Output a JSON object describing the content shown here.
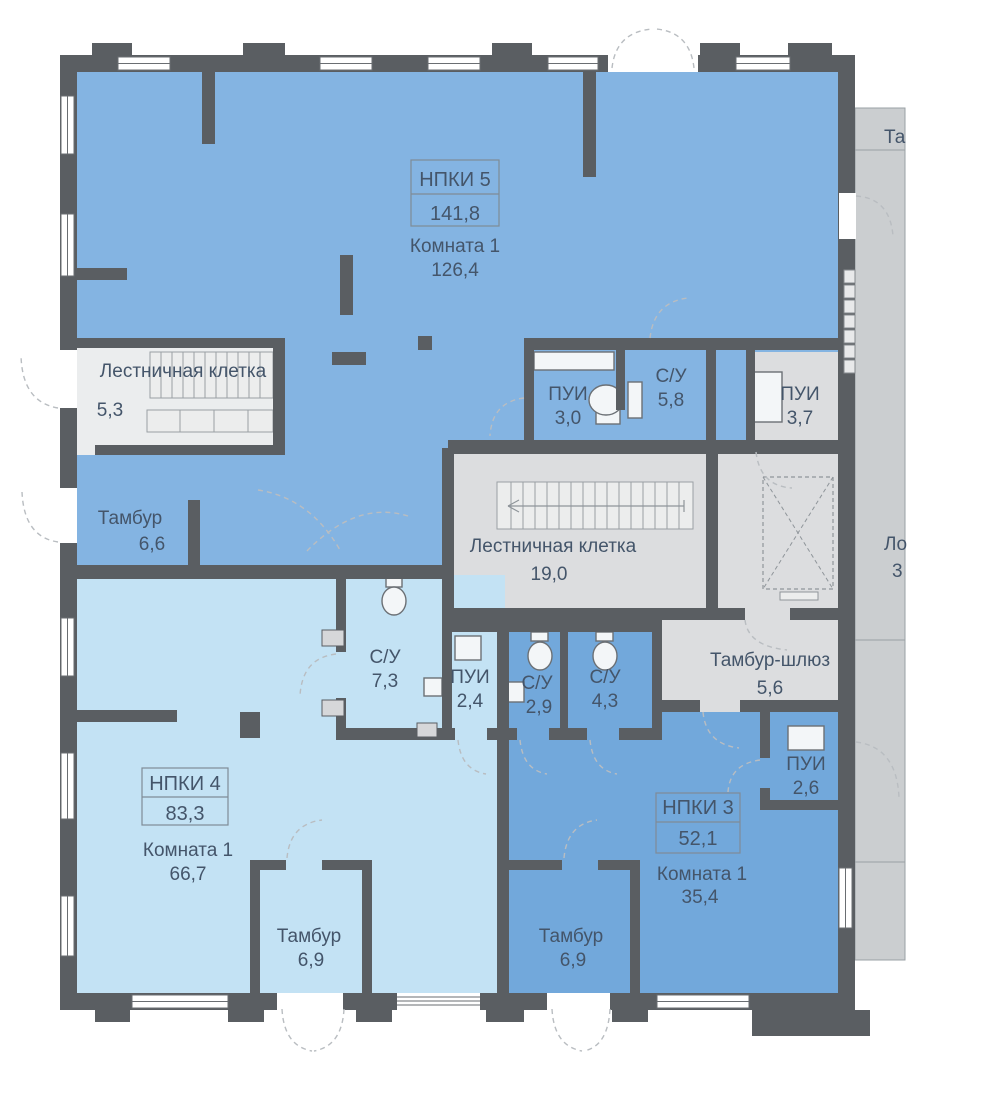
{
  "plan_type": "floor-plan",
  "units": {
    "npki5": {
      "name": "НПКИ 5",
      "area": "141,8",
      "room": "Комната 1",
      "room_area": "126,4"
    },
    "npki4": {
      "name": "НПКИ 4",
      "area": "83,3",
      "room": "Комната 1",
      "room_area": "66,7"
    },
    "npki3": {
      "name": "НПКИ 3",
      "area": "52,1",
      "room": "Комната 1",
      "room_area": "35,4"
    }
  },
  "rooms": {
    "stair_top_left": {
      "label": "Лестничная клетка",
      "area": "5,3"
    },
    "pui_top": {
      "label": "ПУИ",
      "area": "3,0"
    },
    "su_top": {
      "label": "С/У",
      "area": "5,8"
    },
    "pui_top_right": {
      "label": "ПУИ",
      "area": "3,7"
    },
    "tambur_left": {
      "label": "Тамбур",
      "area": "6,6"
    },
    "stair_center": {
      "label": "Лестничная клетка",
      "area": "19,0"
    },
    "su_mid_left": {
      "label": "С/У",
      "area": "7,3"
    },
    "pui_mid": {
      "label": "ПУИ",
      "area": "2,4"
    },
    "su_mid_a": {
      "label": "С/У",
      "area": "2,9"
    },
    "su_mid_b": {
      "label": "С/У",
      "area": "4,3"
    },
    "tambur_shluz": {
      "label": "Тамбур-шлюз",
      "area": "5,6"
    },
    "pui_right": {
      "label": "ПУИ",
      "area": "2,6"
    },
    "tambur_bottom_left": {
      "label": "Тамбур",
      "area": "6,9"
    },
    "tambur_bottom_right": {
      "label": "Тамбур",
      "area": "6,9"
    }
  },
  "edge_labels": {
    "top_right_cutoff": "Та",
    "mid_right_cutoff": "Ло",
    "mid_right_area_cutoff": "3"
  },
  "colors": {
    "wall": "#5a5e62",
    "unit5_fill": "#84b4e2",
    "unit3_fill": "#72a8db",
    "unit4_fill": "#c3e2f4",
    "common_fill": "#dcdddf",
    "stair_room_fill": "#ebedee",
    "loggia_fill": "#cbced0",
    "label_text": "#44556a"
  }
}
